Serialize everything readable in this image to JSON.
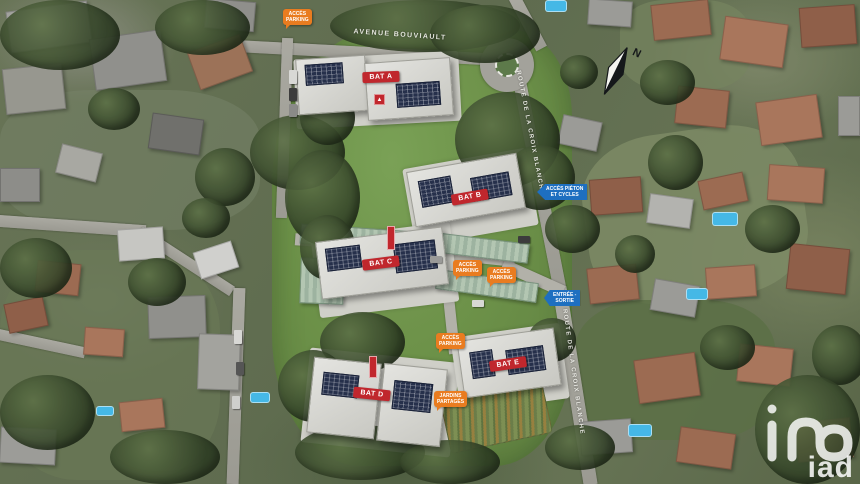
{
  "streets": {
    "avenue": "AVENUE BOUVIAULT",
    "route_upper": "ROUTE DE LA CROIX BLANCHE",
    "route_lower": "ROUTE DE LA CROIX BLANCHE"
  },
  "buildings": [
    {
      "label": "BAT A"
    },
    {
      "label": "BAT B"
    },
    {
      "label": "BAT C"
    },
    {
      "label": "BAT D"
    },
    {
      "label": "BAT E"
    }
  ],
  "access_labels": {
    "parking_top": {
      "line1": "ACCÈS",
      "line2": "PARKING"
    },
    "parking_c1": {
      "line1": "ACCÈS",
      "line2": "PARKING"
    },
    "parking_c2": {
      "line1": "ACCÈS",
      "line2": "PARKING"
    },
    "parking_e": {
      "line1": "ACCÈS",
      "line2": "PARKING"
    },
    "gardens": {
      "line1": "JARDINS",
      "line2": "PARTAGÉS"
    },
    "pedestrian": {
      "line1": "ACCÈS PIÉTON",
      "line2": "ET CYCLES"
    },
    "entrance": {
      "line1": "ENTRÉE -",
      "line2": "SORTIE"
    }
  },
  "markers": {
    "warning_glyph": "▲"
  },
  "compass": {
    "north": "N"
  },
  "logo": {
    "brand": "iad"
  },
  "colors": {
    "building_tag": "#c0272d",
    "access_tag": "#e97c20",
    "direction_tag": "#1e6fc0"
  }
}
